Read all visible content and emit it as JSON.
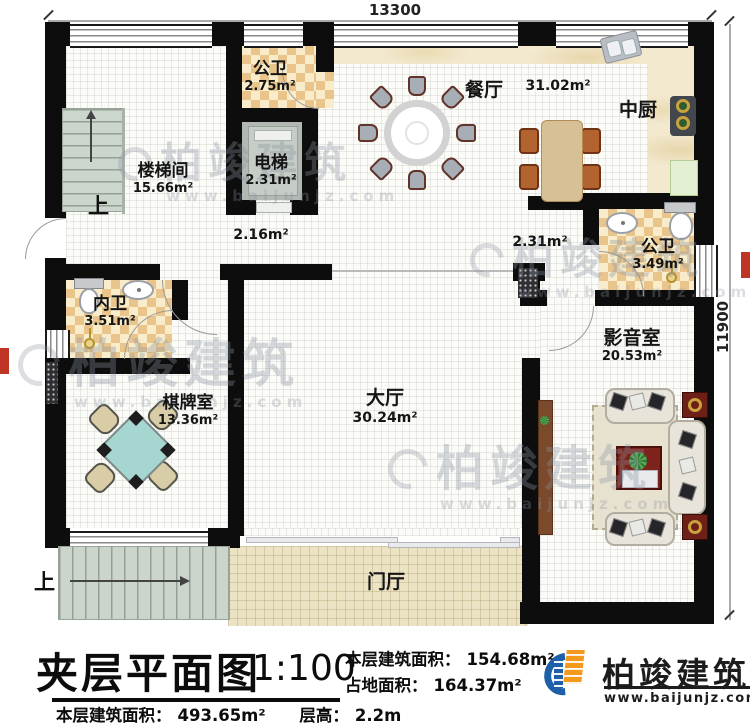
{
  "dims": {
    "top": "13300",
    "right": "11900"
  },
  "rooms": {
    "stair_hall": {
      "name": "楼梯间",
      "area": "15.66m²"
    },
    "bath_top": {
      "name": "公卫",
      "area": "2.75m²"
    },
    "elevator": {
      "name": "电梯",
      "area": "2.31m²"
    },
    "dining": {
      "name": "餐厅",
      "area": "31.02m²"
    },
    "kitchen": {
      "name": "中厨"
    },
    "hall_small_left": {
      "area": "2.16m²"
    },
    "hall_small_right": {
      "area": "2.31m²"
    },
    "bath_right": {
      "name": "公卫",
      "area": "3.49m²"
    },
    "bath_inner": {
      "name": "内卫",
      "area": "3.51m²"
    },
    "media": {
      "name": "影音室",
      "area": "20.53m²"
    },
    "game": {
      "name": "棋牌室",
      "area": "13.36m²"
    },
    "hall_main": {
      "name": "大厅",
      "area": "30.24m²"
    },
    "foyer": {
      "name": "门厅"
    }
  },
  "stairs": {
    "up": "上"
  },
  "title_block": {
    "title": "夹层平面图",
    "scale": "1:100",
    "floor_area_label": "本层建筑面积：",
    "floor_area_value": "154.68m²",
    "land_area_label": "占地面积：",
    "land_area_value": "164.37m²",
    "total_area_label": "本层建筑面积：",
    "total_area_value": "493.65m²",
    "floor_height_label": "层高：",
    "floor_height_value": "2.2m"
  },
  "logo": {
    "name": "柏竣建筑",
    "url": "www.baijunjz.com"
  },
  "watermark": {
    "text": "柏竣建筑",
    "url": "www.baijunjz.com"
  },
  "colors": {
    "wall": "#0d0d0d",
    "checker_dark": "#e9c58c",
    "checker_light": "#f8ecca",
    "logo_blue": "#1d5fa8",
    "logo_orange": "#f5991d",
    "stamp_red": "#c03426"
  }
}
